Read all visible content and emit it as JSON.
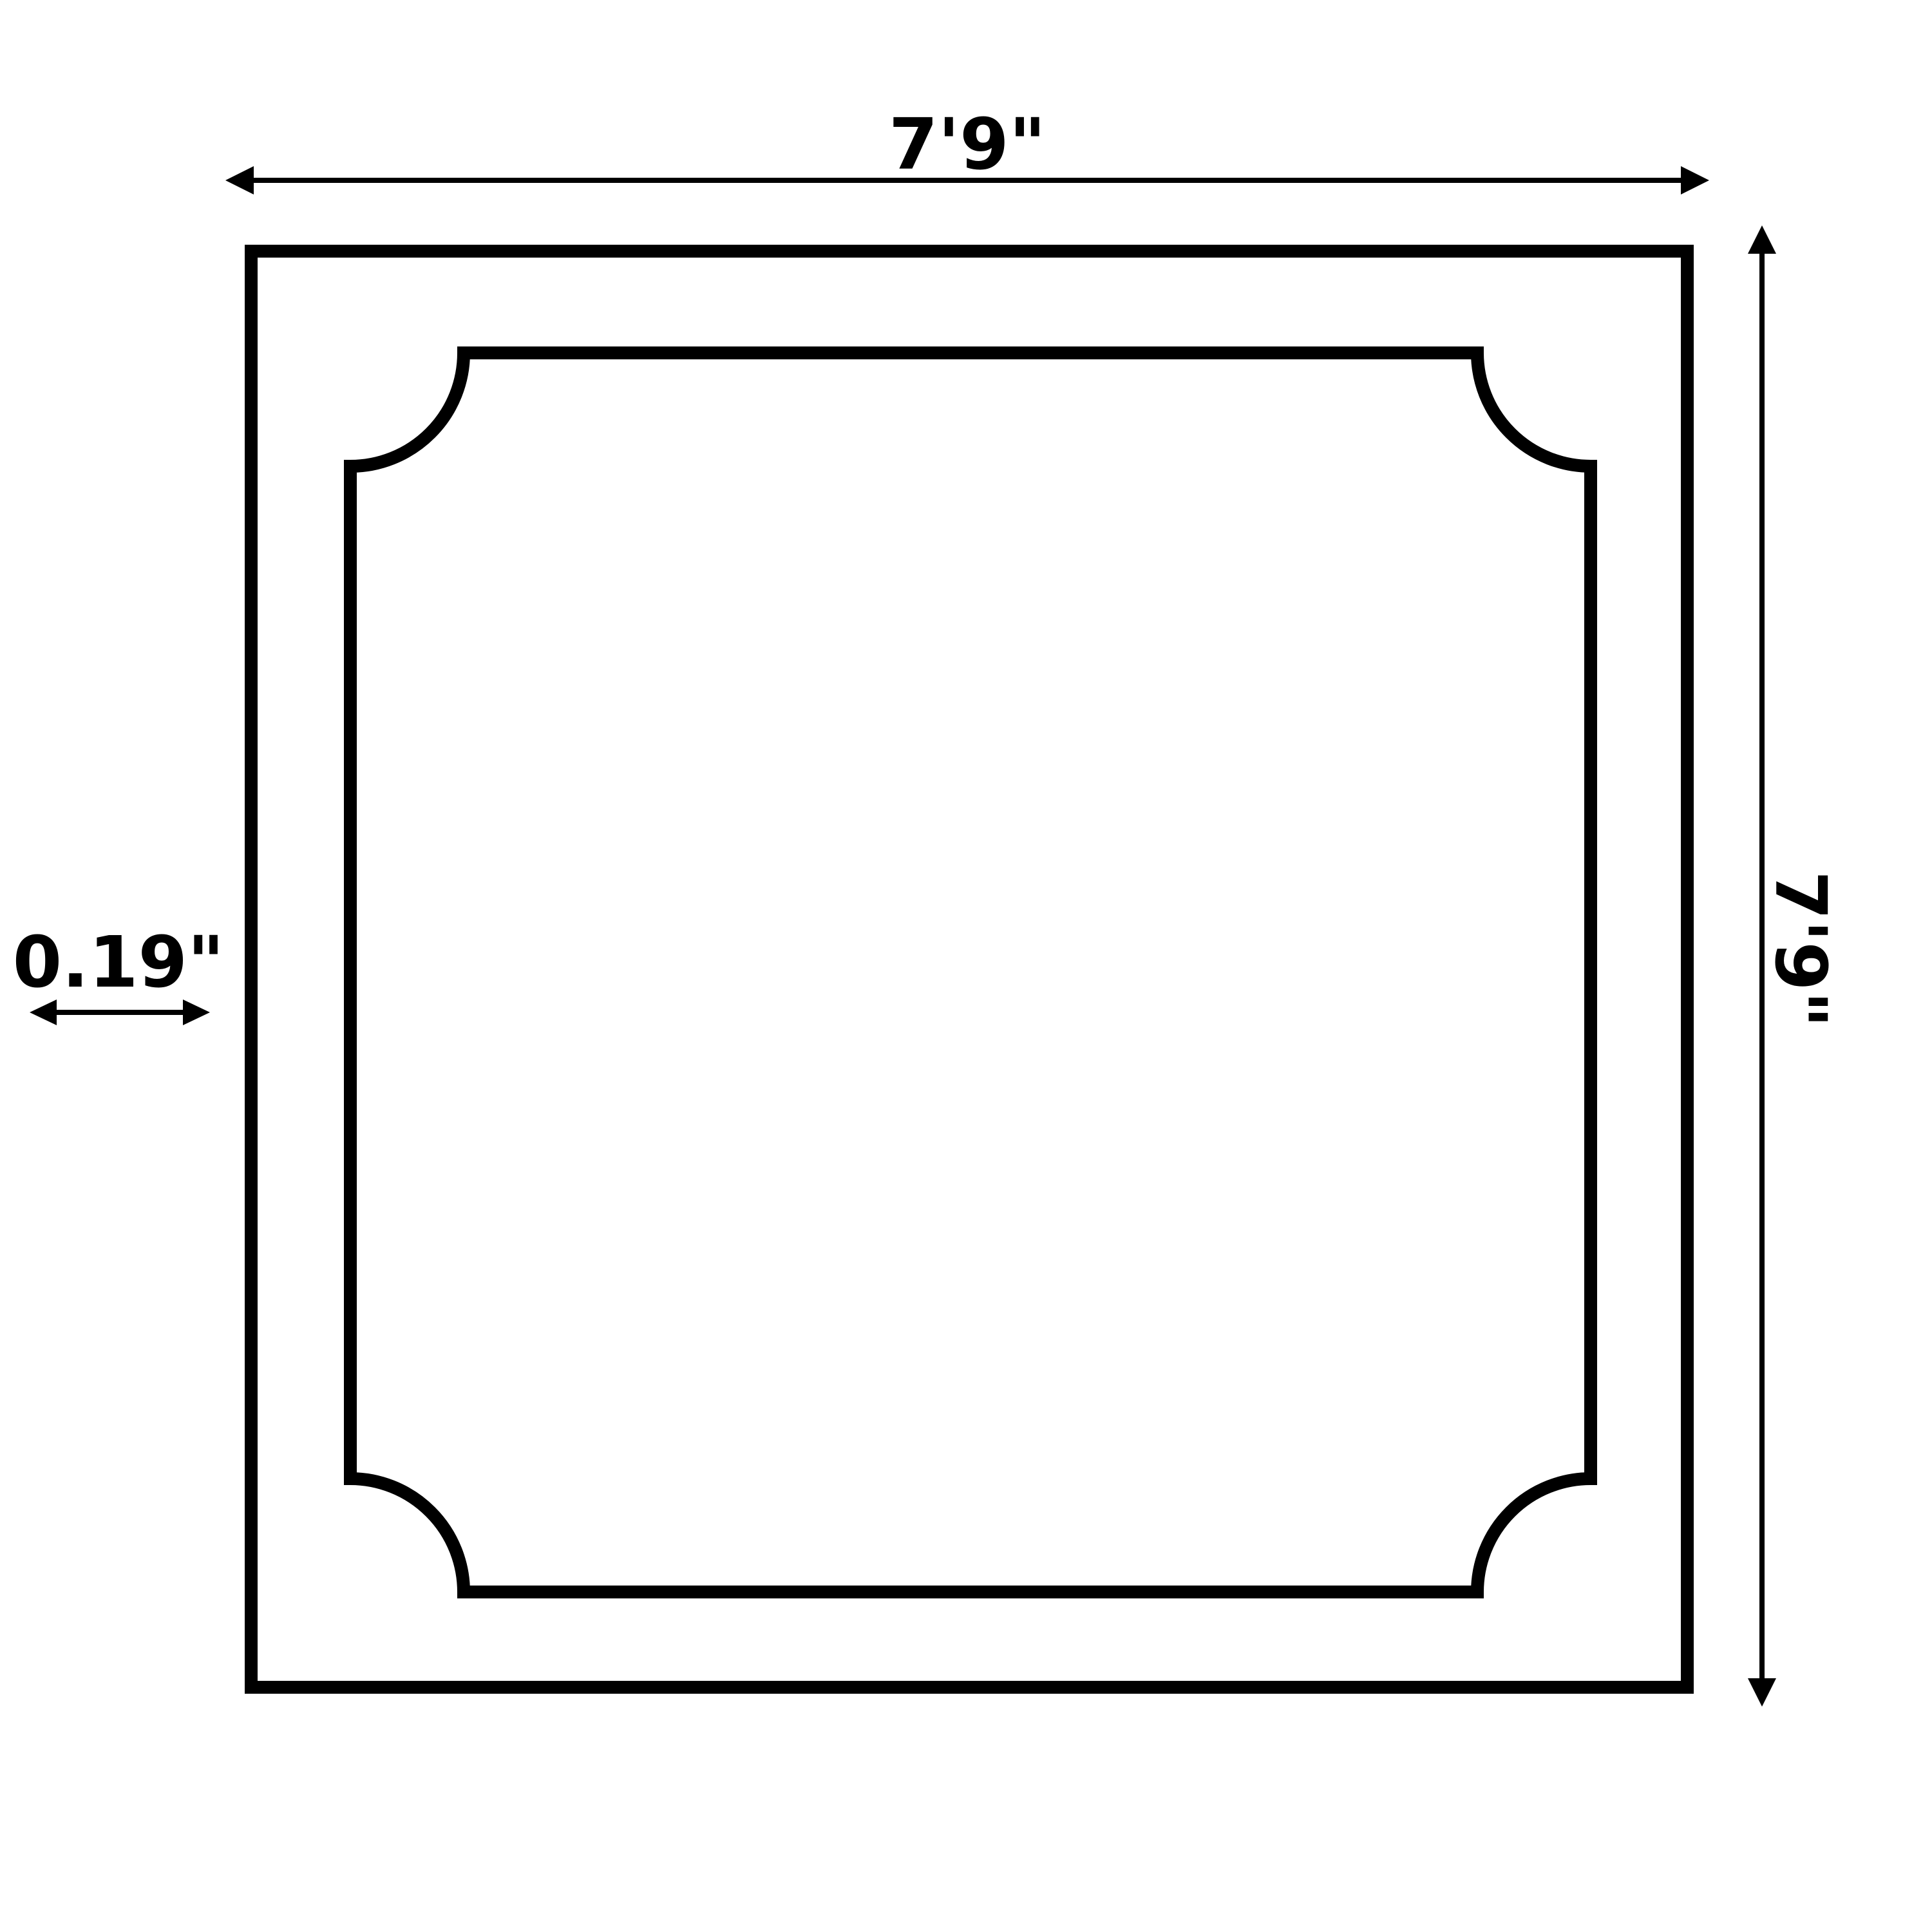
{
  "diagram": {
    "description": "square panel plan drawing with scalloped corner inner outline",
    "background_color": "#ffffff",
    "line_color": "#000000",
    "dimensions": {
      "top": {
        "label": "7'9\""
      },
      "right": {
        "label": "7'9\""
      },
      "left": {
        "label": "0.19\""
      }
    }
  }
}
